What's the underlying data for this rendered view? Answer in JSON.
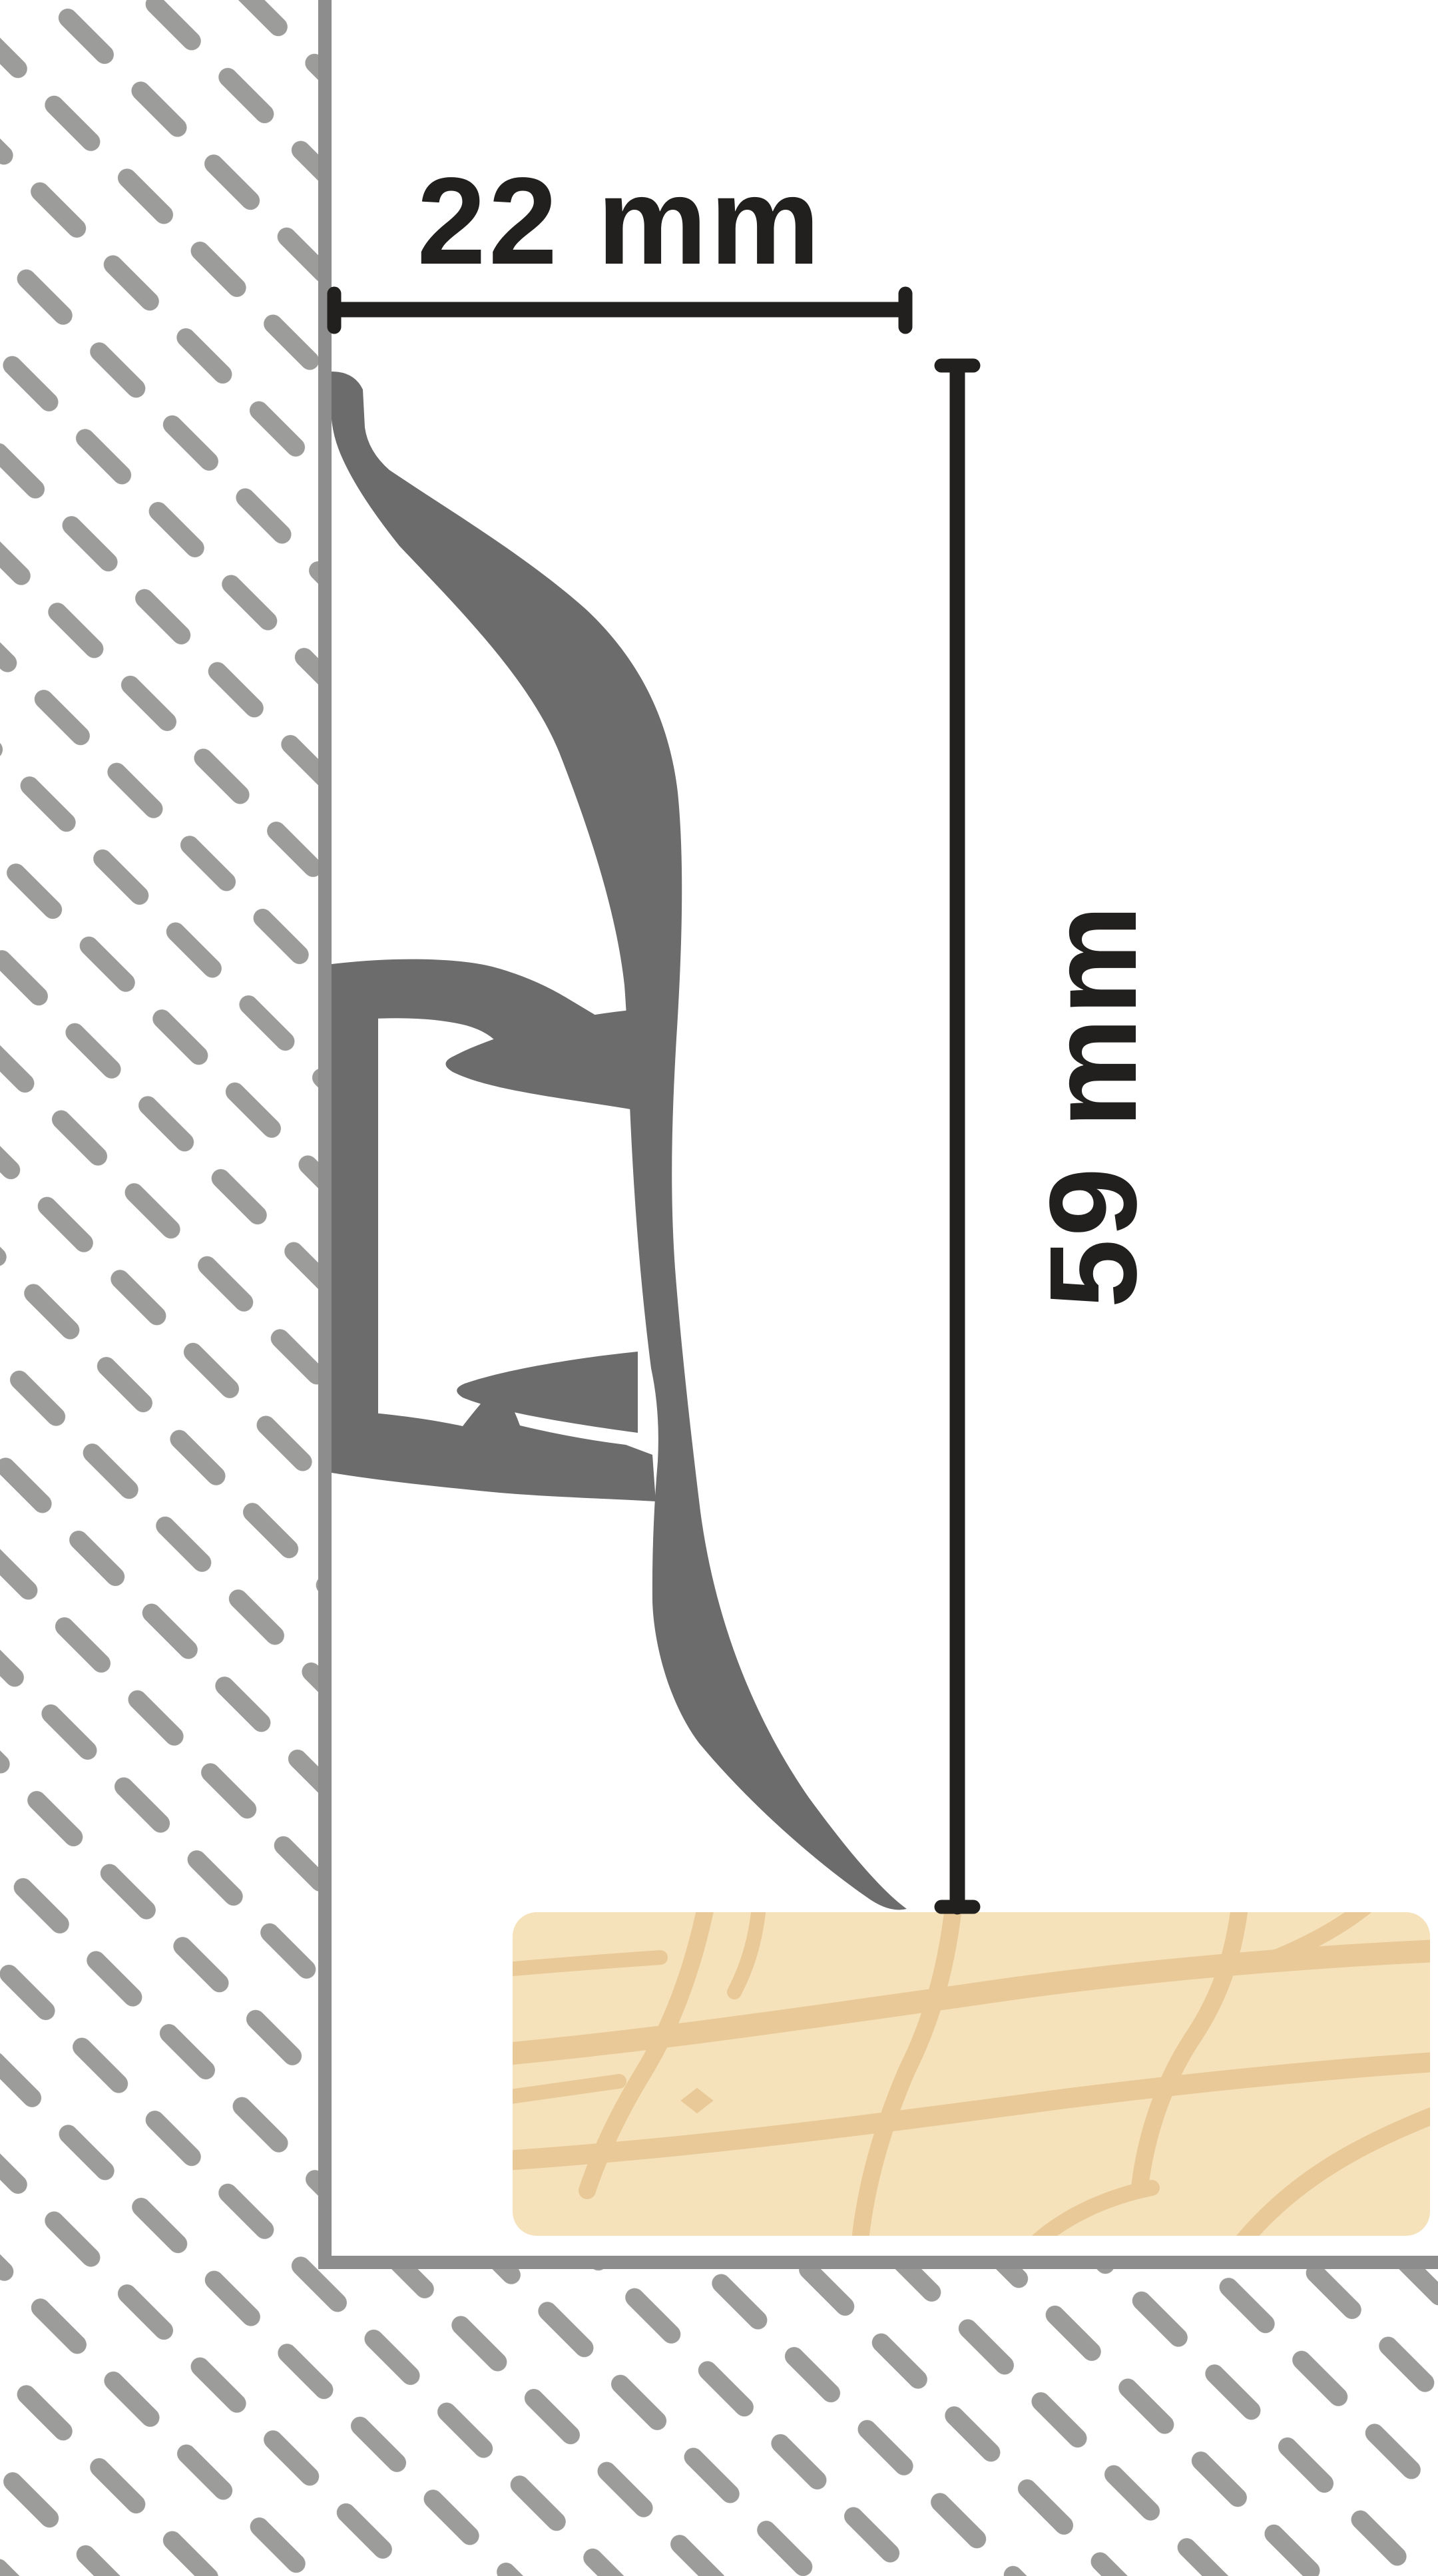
{
  "diagram": {
    "type": "skirting-board-cross-section",
    "dimensions": {
      "width_label": "22 mm",
      "height_label": "59 mm"
    },
    "colors": {
      "background": "#ffffff",
      "hatch": "#9c9c9a",
      "wall_floor_line": "#8d8d8d",
      "profile": "#6c6c6c",
      "dimension_line": "#21201e",
      "floor_base": "#f5e2bb",
      "floor_grain": "#e9c997"
    }
  }
}
